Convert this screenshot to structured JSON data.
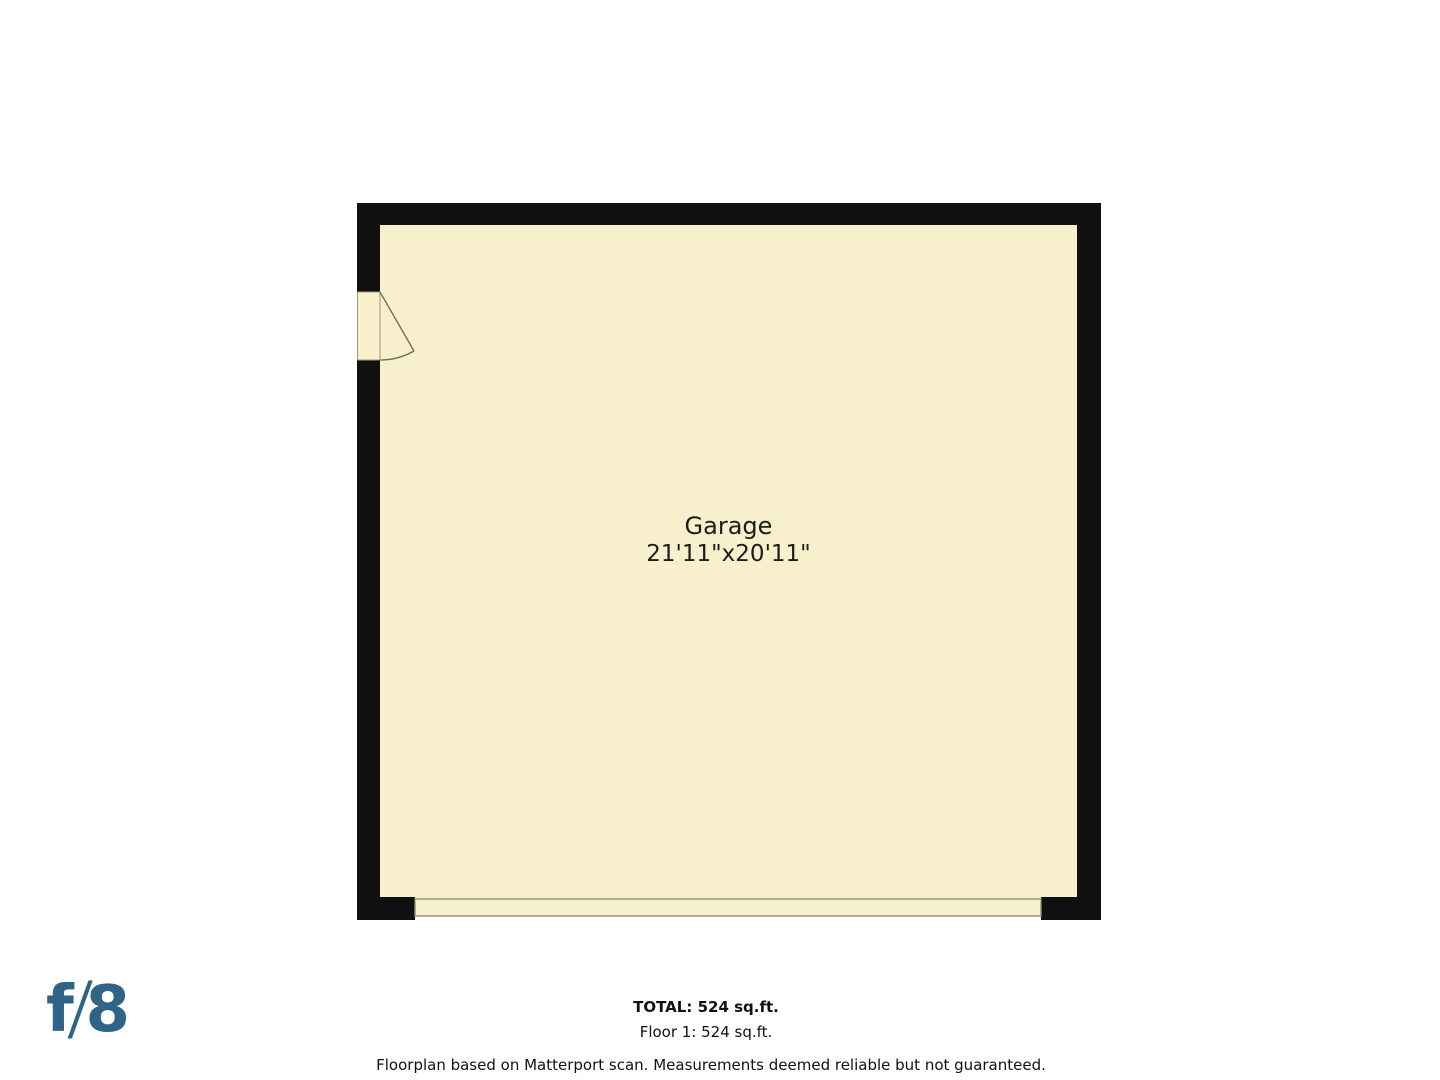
{
  "plan": {
    "room_label": "Garage",
    "room_dimensions": "21'11\"x20'11\""
  },
  "summary": {
    "total": "TOTAL: 524 sq.ft.",
    "floor_1": "Floor 1: 524 sq.ft."
  },
  "disclaimer": "Floorplan based on Matterport scan. Measurements deemed reliable but not guaranteed.",
  "logo": {
    "f": "f",
    "slash": "/",
    "eight": "8"
  },
  "colors": {
    "floor_fill": "#f8f0cd",
    "wall": "#101010",
    "door_outline": "#99997a",
    "door_swing": "#6c6c52",
    "garage_door_line": "#8f8f6e",
    "label_text": "#1c1c1c",
    "logo_blue": "#2e6586"
  }
}
